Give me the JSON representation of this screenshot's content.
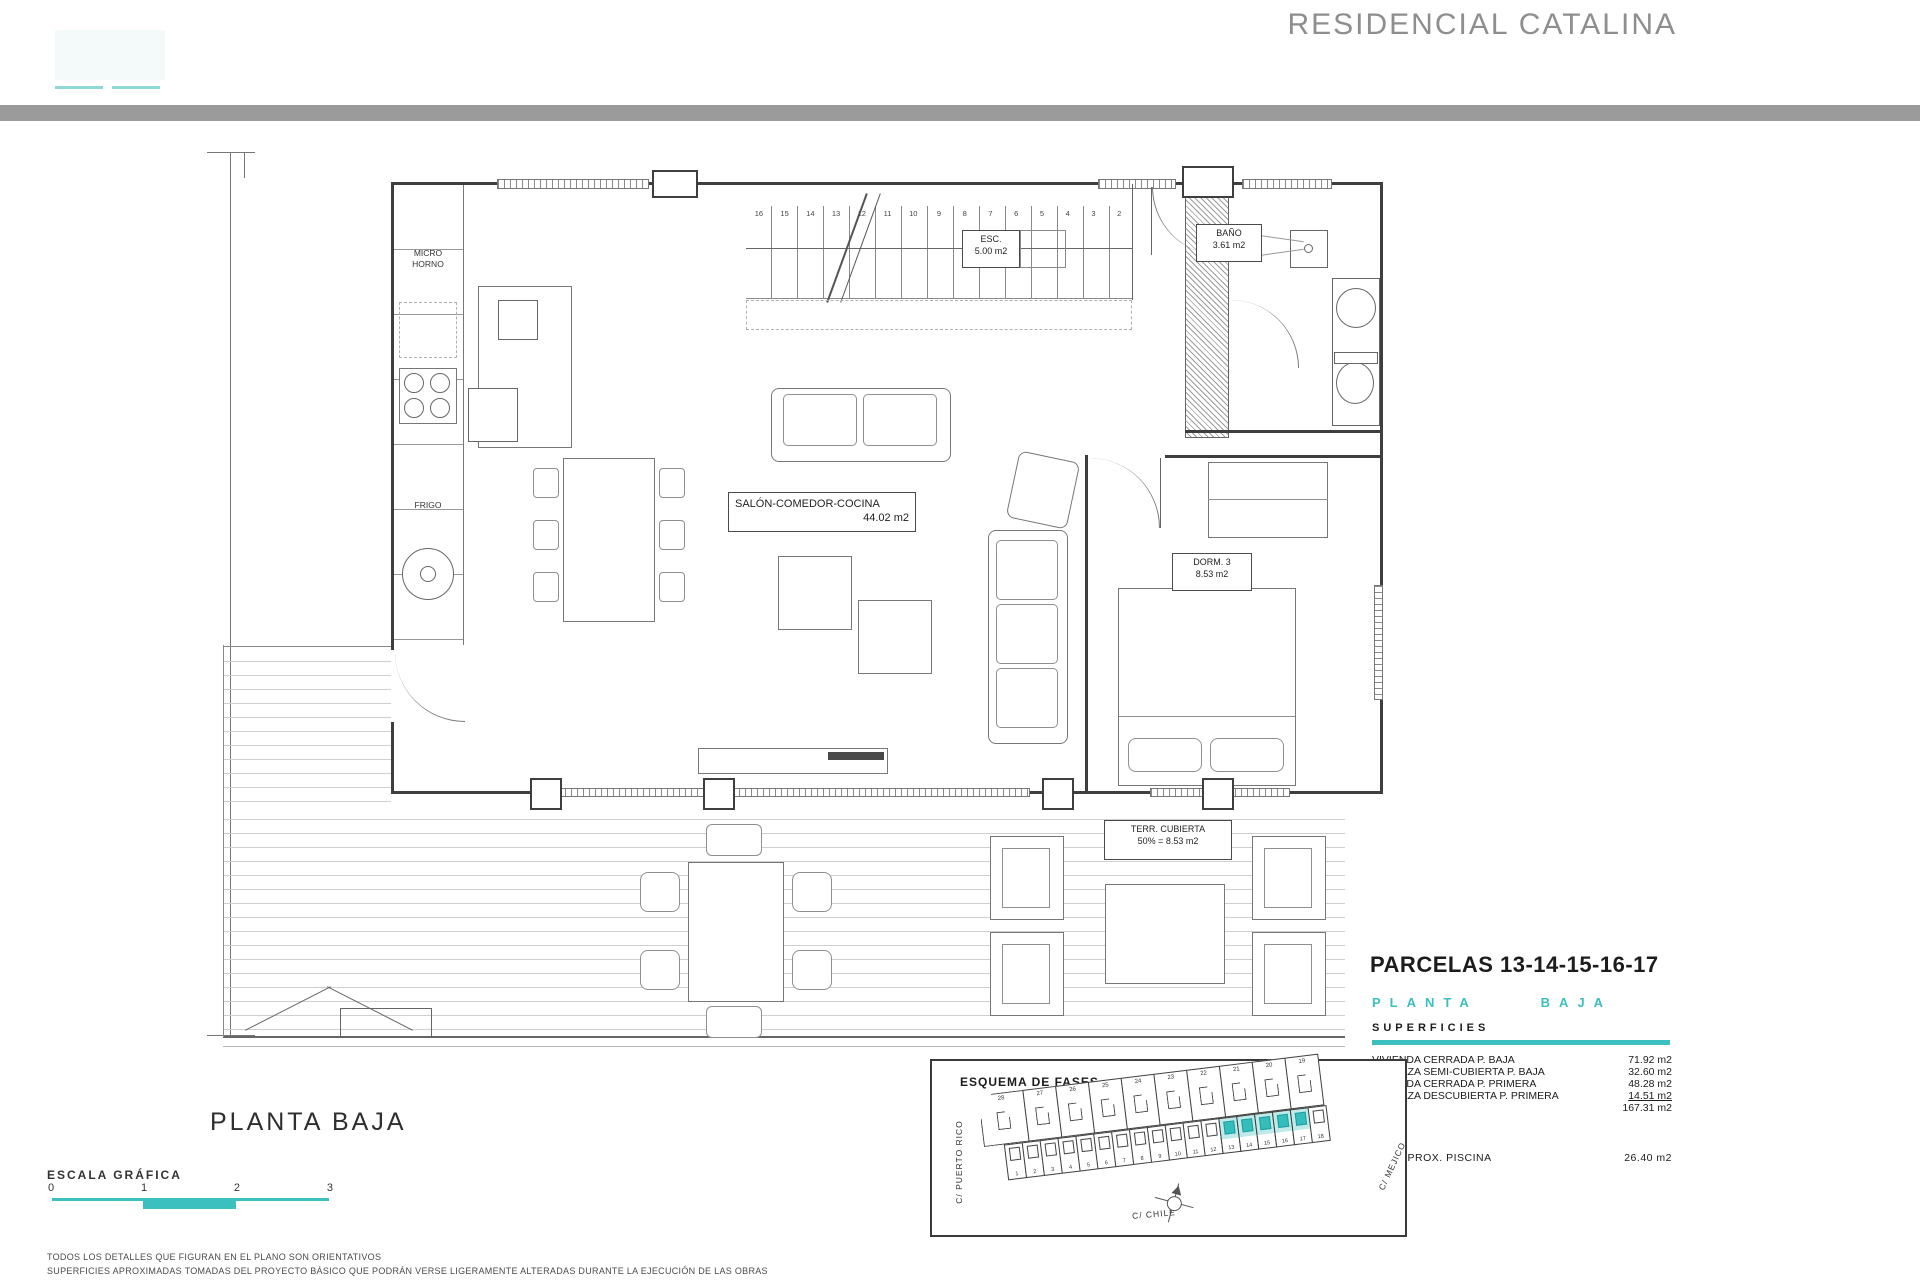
{
  "header": {
    "project_title": "RESIDENCIAL CATALINA"
  },
  "colors": {
    "accent": "#3bbfbf",
    "accent_light": "#8fd8d8",
    "header_bar": "#9b9b9b",
    "title_gray": "#8e8e8e"
  },
  "plan": {
    "labels": {
      "salon": {
        "line1": "SALÓN-COMEDOR-COCINA",
        "line2": "44.02 m2"
      },
      "esc": {
        "line1": "ESC.",
        "line2": "5.00 m2"
      },
      "bano": {
        "line1": "BAÑO",
        "line2": "3.61 m2"
      },
      "dorm": {
        "line1": "DORM. 3",
        "line2": "8.53 m2"
      },
      "terraza": {
        "line1": "TERR. CUBIERTA",
        "line2": "50% = 8.53 m2"
      },
      "micro": {
        "line1": "MICRO",
        "line2": "HORNO"
      },
      "frigo": "FRIGO"
    },
    "stair_numbers": [
      "16",
      "15",
      "14",
      "13",
      "12",
      "11",
      "10",
      "9",
      "8",
      "7",
      "6",
      "5",
      "4",
      "3",
      "2"
    ]
  },
  "footer": {
    "plan_title": "PLANTA BAJA",
    "scale_label": "ESCALA GRÁFICA",
    "scale_ticks": [
      "0",
      "1",
      "2",
      "3"
    ],
    "disclaimer_line1": "TODOS LOS DETALLES QUE FIGURAN EN EL PLANO SON ORIENTATIVOS",
    "disclaimer_line2": "SUPERFICIES APROXIMADAS TOMADAS DEL PROYECTO BÁSICO QUE PODRÁN VERSE LIGERAMENTE ALTERADAS DURANTE LA EJECUCIÓN DE LAS OBRAS"
  },
  "summary": {
    "parcels_title": "PARCELAS 13-14-15-16-17",
    "floor_word1": "PLANTA",
    "floor_word2": "BAJA",
    "section_label": "SUPERFICIES",
    "rows": [
      {
        "label": "VIVIENDA CERRADA P. BAJA",
        "value": "71.92 m2"
      },
      {
        "label": "TERRAZA SEMI-CUBIERTA P. BAJA",
        "value": "32.60 m2"
      },
      {
        "label": "VIVIENDA CERRADA P. PRIMERA",
        "value": "48.28 m2"
      },
      {
        "label": "TERRAZA DESCUBIERTA P. PRIMERA",
        "value": "14.51 m2",
        "underline": true
      },
      {
        "label": "TOTAL",
        "value": "167.31 m2"
      }
    ],
    "pool_row": {
      "label": "SUP. APROX. PISCINA",
      "value": "26.40 m2"
    }
  },
  "esquema": {
    "title": "ESQUEMA DE FASES",
    "street_top": "C/ ARGENTINA",
    "street_left": "C/ PUERTO RICO",
    "street_bottom": "C/ CHILE",
    "street_right": "C/ MEJICO",
    "top_row_plots": [
      "28",
      "27",
      "26",
      "25",
      "24",
      "23",
      "22",
      "21",
      "20",
      "19"
    ],
    "bottom_row_plots": [
      "1",
      "2",
      "3",
      "4",
      "5",
      "6",
      "7",
      "8",
      "9",
      "10",
      "11",
      "12",
      "13",
      "14",
      "15",
      "16",
      "17",
      "18"
    ],
    "highlighted_plots": [
      "13",
      "14",
      "15",
      "16",
      "17"
    ]
  }
}
